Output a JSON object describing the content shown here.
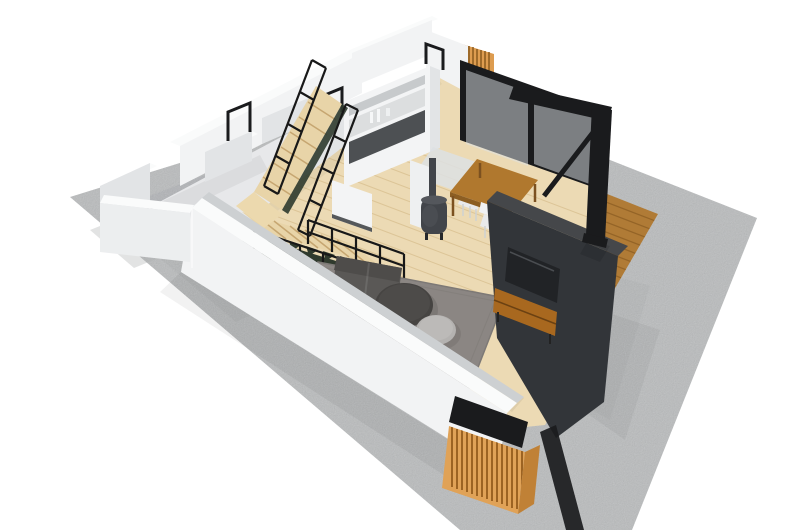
{
  "canvas": {
    "width": 787,
    "height": 530
  },
  "scene": {
    "type": "3d-floorplan-cutaway-render",
    "description": "Axonometric cutaway 3D render of a small open-plan house on a concrete slab: living room with rug, sofa and round coffee tables, wood stove, dining table with white chairs, kitchen island, L-shaped timber staircase with black metal railing, dark TV wall with media console, glass sliding door to a timber deck with black steel frame, and a timber-slat corner screen.",
    "items": [
      "concrete-slab",
      "back-rooms",
      "doorways",
      "kitchen-island",
      "glass-sliding-door",
      "timber-screen",
      "wood-floor",
      "staircase",
      "stair-railing",
      "wood-stove",
      "dining-table",
      "dining-chairs",
      "runner-rug",
      "area-rug",
      "sofa",
      "coffee-table-large",
      "coffee-table-small",
      "tv-wall",
      "tv",
      "media-console",
      "timber-deck",
      "pergola-frame",
      "front-facade-wall",
      "slat-corner-screen"
    ]
  },
  "palette": {
    "background": "#ffffff",
    "concrete": "#cbcdce",
    "concrete_dark": "#bec0c2",
    "wall_bright": "#f2f3f4",
    "wall_top": "#fafbfb",
    "wall_shade": "#e2e4e6",
    "wall_deep": "#cdd0d2",
    "room_floor": "#e7e8ea",
    "wood_floor": "#ecdab4",
    "plank_line": "#c9ab74",
    "stair_wood": "#e8d4a8",
    "stair_stripe": "#c6a671",
    "landing_wood": "#ecd9ae",
    "stringer_green": "#2f3a2d",
    "railing_black": "#181818",
    "island_white": "#f3f4f5",
    "island_steel": "#c7cacc",
    "island_recess": "#dcdedf",
    "island_dark": "#4d5053",
    "glass_tint": "#dde4e7",
    "frame_black": "#1a1b1d",
    "deck_wood": "#b07b36",
    "deck_line": "#7e521c",
    "screen_orange": "#dd9c50",
    "screen_line": "#8a5a1e",
    "slat_light": "#e0a257",
    "slat_dark": "#9c6322",
    "table_wood": "#b0782e",
    "table_edge": "#8c5e22",
    "chair_white": "#f1f2f3",
    "runner_rug": "#dde1e3",
    "hearth_white": "#eef0f1",
    "stove_body": "#42454a",
    "stove_dark": "#26282b",
    "rug_gray": "#8b8683",
    "rug_edge": "#7d7976",
    "sofa_gray": "#5a5856",
    "sofa_dark": "#4e4c4a",
    "ct_large": "#464442",
    "ct_large_top": "#4d4b49",
    "ct_small": "#b4b2b0",
    "ct_small_top": "#bcbab8",
    "tv_wall": "#323539",
    "tv_wall_top": "#45474a",
    "tv_screen": "#212326",
    "console_wood": "#a8681f"
  }
}
